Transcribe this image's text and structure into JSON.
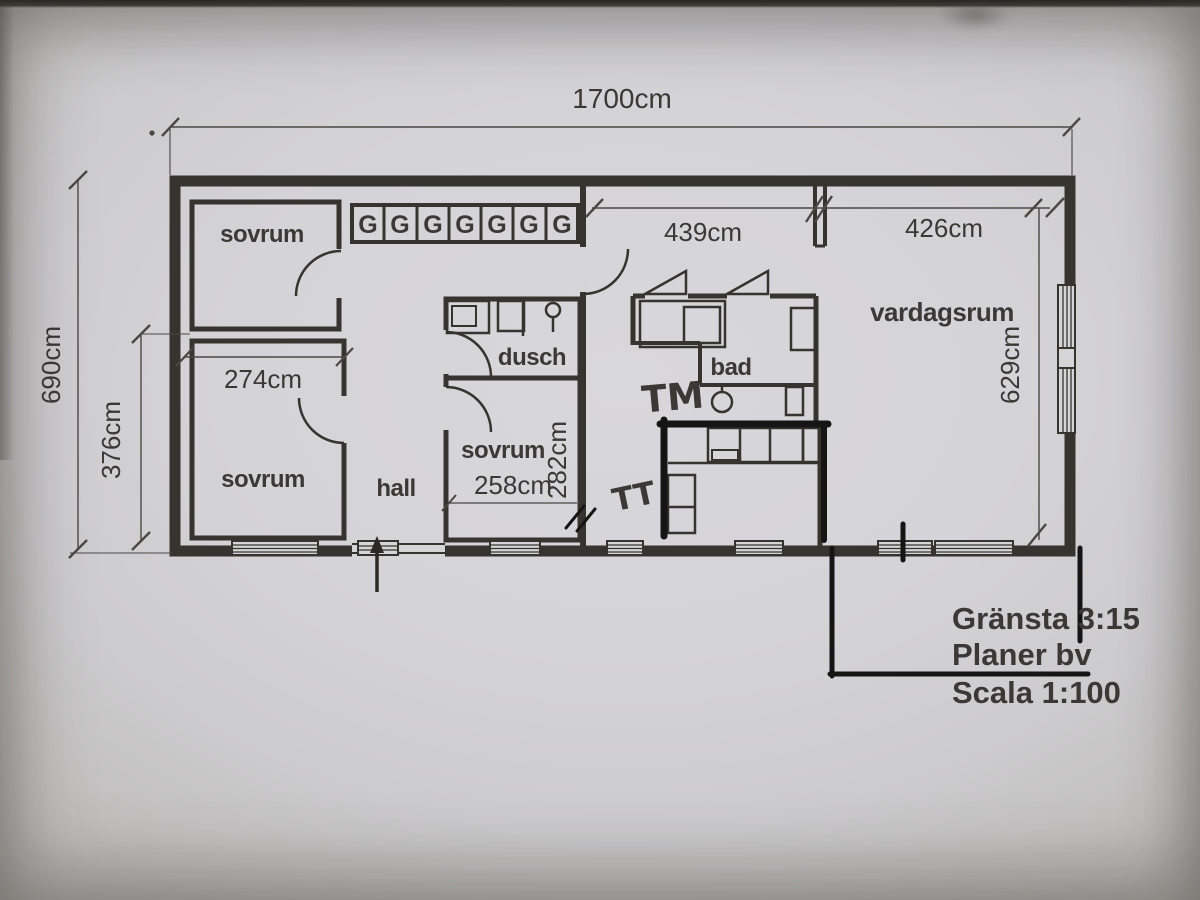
{
  "dimensions": {
    "overall_width": "1700cm",
    "overall_height": "690cm",
    "left_lower_height": "376cm",
    "left_room_width": "274cm",
    "mid_section_width": "439cm",
    "living_section_width": "426cm",
    "living_depth": "629cm",
    "mid_bedroom_width": "258cm",
    "mid_bedroom_depth": "282cm"
  },
  "rooms": {
    "bedroom_nw": "sovrum",
    "bedroom_sw": "sovrum",
    "bedroom_mid": "sovrum",
    "hall": "hall",
    "shower": "dusch",
    "bath": "bad",
    "living": "vardagsrum"
  },
  "closets": {
    "letters": [
      "G",
      "G",
      "G",
      "G",
      "G",
      "G",
      "G"
    ]
  },
  "handwritten": {
    "washer_mark": "TM",
    "dryer_mark": "TT"
  },
  "title_block": {
    "line1": "Gränsta 3:15",
    "line2": "Planer bv",
    "line3": "Scala 1:100"
  },
  "colors": {
    "paper": "#d5d4d7",
    "ink": "#35342f",
    "pen": "#151514"
  }
}
